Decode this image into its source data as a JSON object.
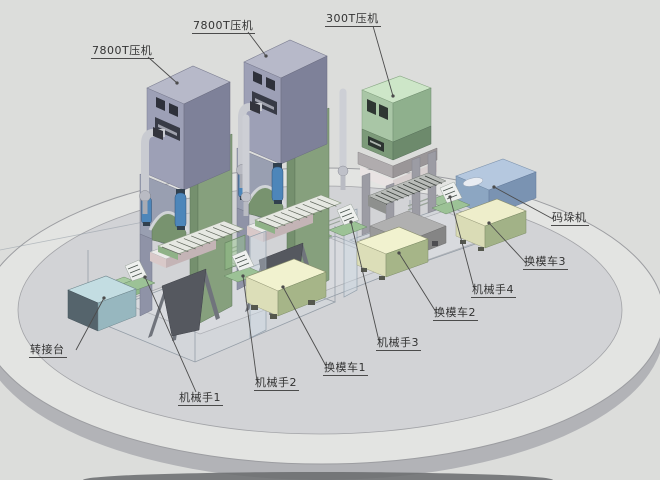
{
  "diagram": {
    "type": "3d-production-line-layout",
    "callouts": {
      "press_7800_left": {
        "label": "7800T压机"
      },
      "press_7800_mid": {
        "label": "7800T压机"
      },
      "press_300": {
        "label": "300T压机"
      },
      "palletizer": {
        "label": "码垛机"
      },
      "mold_cart_3": {
        "label": "换模车3"
      },
      "robot_arm_4": {
        "label": "机械手4"
      },
      "mold_cart_2": {
        "label": "换模车2"
      },
      "robot_arm_3": {
        "label": "机械手3"
      },
      "mold_cart_1": {
        "label": "换模车1"
      },
      "robot_arm_2": {
        "label": "机械手2"
      },
      "robot_arm_1": {
        "label": "机械手1"
      },
      "transfer_table": {
        "label": "转接台"
      }
    },
    "colors": {
      "background": "#dcdddb",
      "platform_ring": "#e3e4e2",
      "platform_inner": "#d2d3d6",
      "platform_side": "#b2b3b7",
      "press_top": "#b7b9c9",
      "press_front": "#9da0b6",
      "press_side": "#7e8199",
      "press_column_green": "#86a07d",
      "cylinder_blue": "#4d86ba",
      "pipe_gray": "#c9cbd1",
      "press300_top": "#cde6c8",
      "press300_front": "#a9c6a6",
      "press300_band": "#7c9a79",
      "palletizer_blue": "#b5c8df",
      "mold_cart_cream": "#f1f2cf",
      "transfer_table_cyan": "#c3dde2",
      "robot_green": "#9cc296",
      "label_text": "#333333",
      "leader_line": "#4c4c4c"
    }
  }
}
